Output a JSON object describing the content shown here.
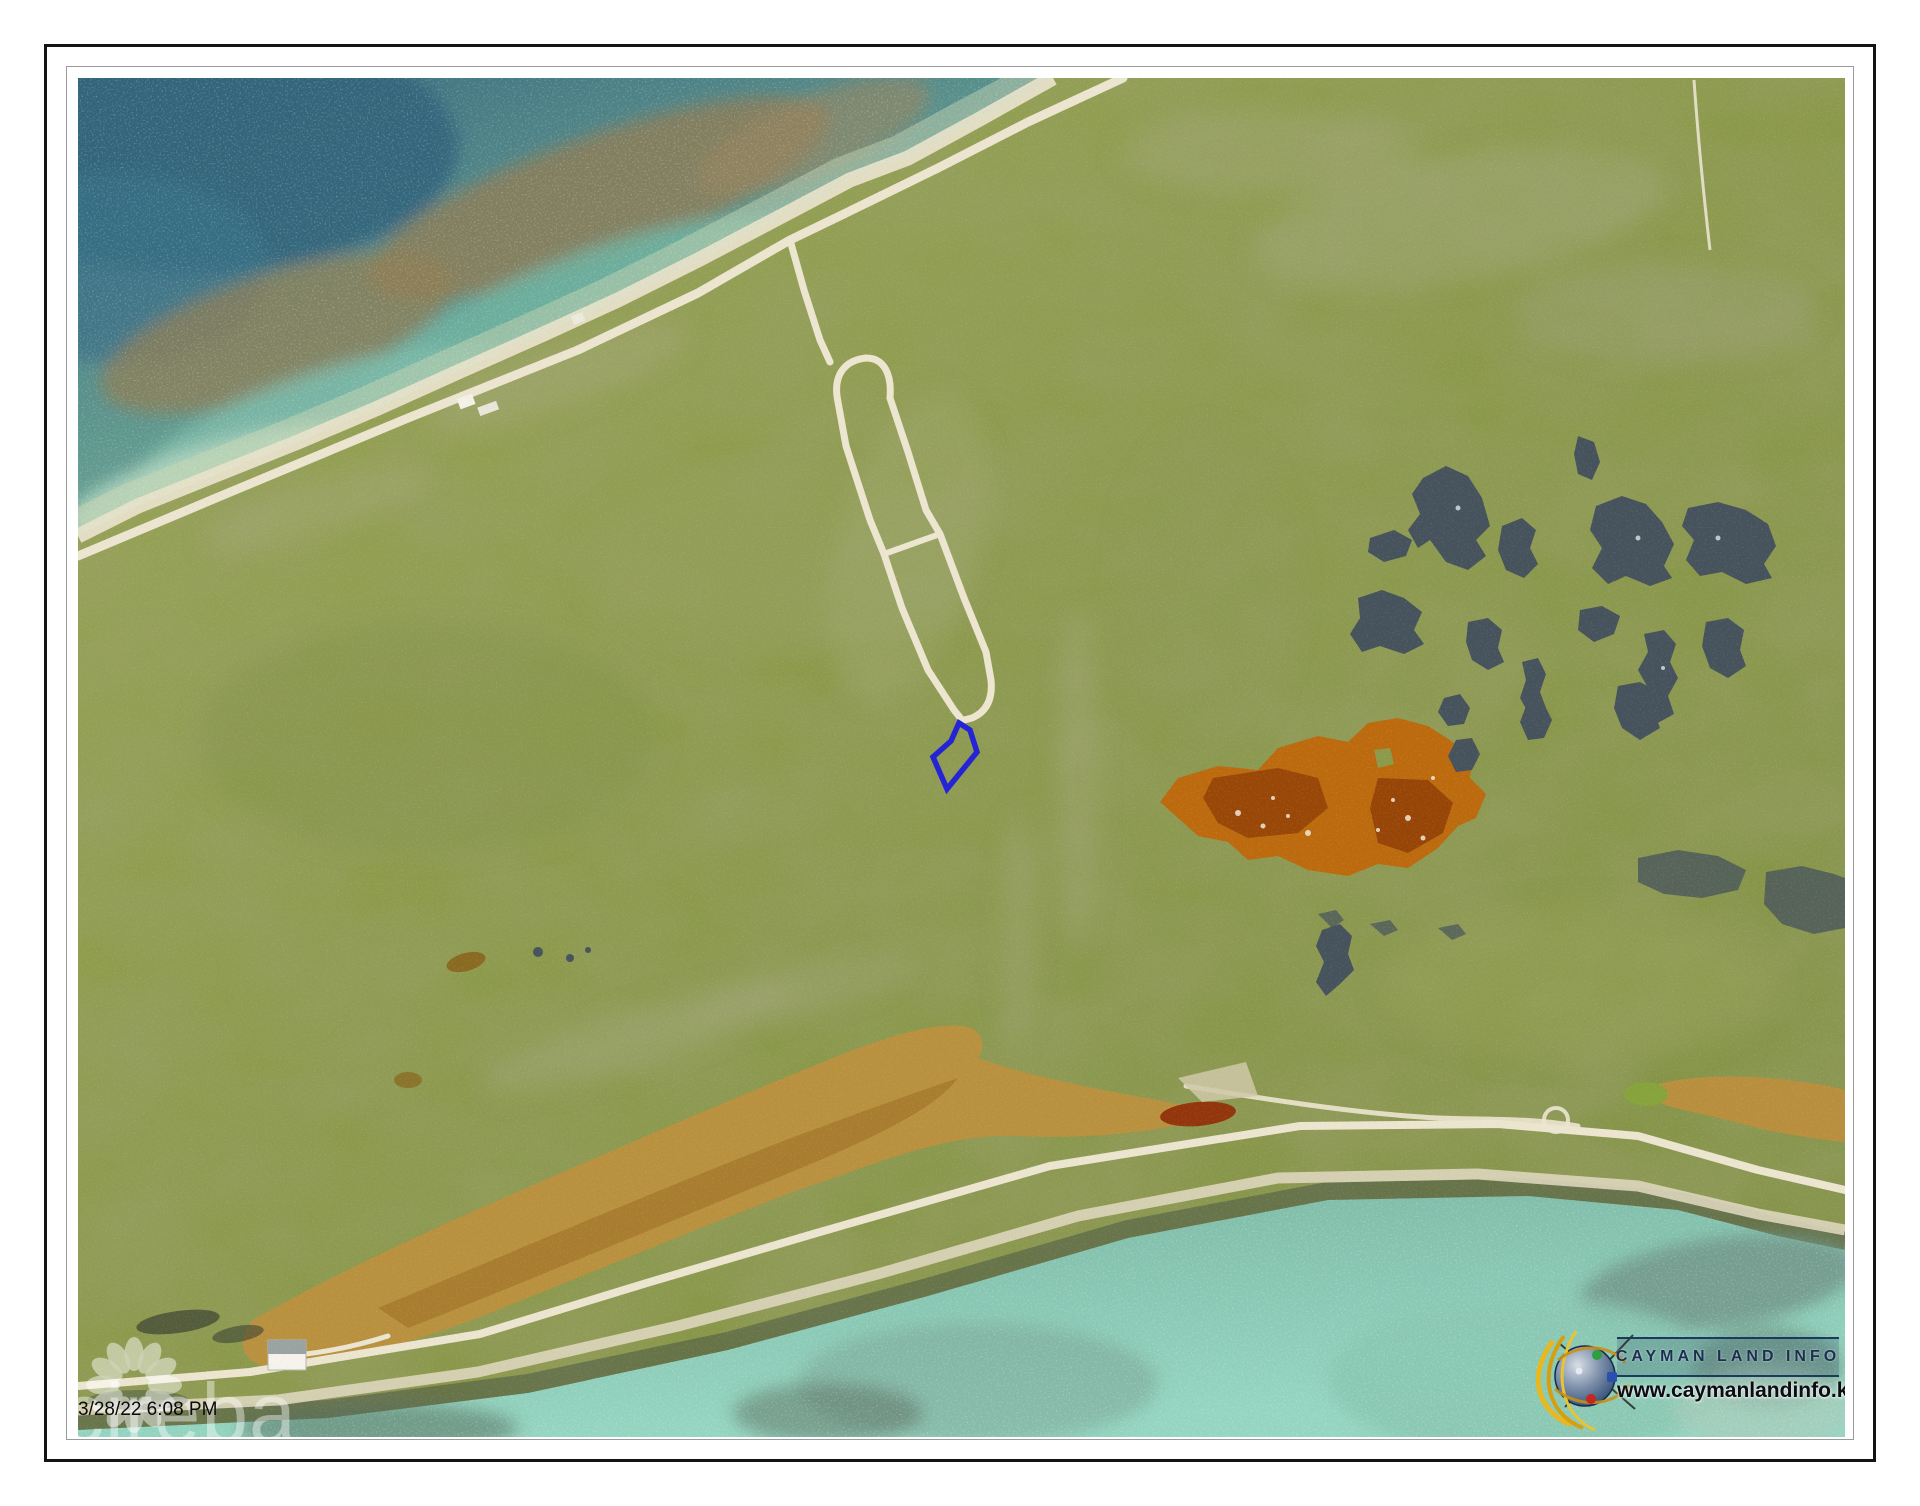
{
  "map_overlay": {
    "timestamp": "3/28/22 6:08 PM",
    "watermark": "cireba"
  },
  "branding": {
    "name": "CAYMAN LAND INFO",
    "url": "www.caymanlandinfo.ky"
  },
  "icons": {
    "watermark_logo": "flower-icon",
    "branding_logo": "globe-icon"
  },
  "colors": {
    "parcel_outline": "#2424d6",
    "road": "#ece5d0",
    "vegetation": "#8b9a4c",
    "ocean_deep": "#30647c",
    "ocean_shallow": "#92d4c0",
    "reef_brown": "#8d7c55",
    "pond_orange": "#bd6a0e",
    "pond_dark": "#46525c",
    "lagoon_tan": "#b9913f",
    "sand": "#e7e1c9",
    "brand_navy": "#1c3a5e"
  }
}
